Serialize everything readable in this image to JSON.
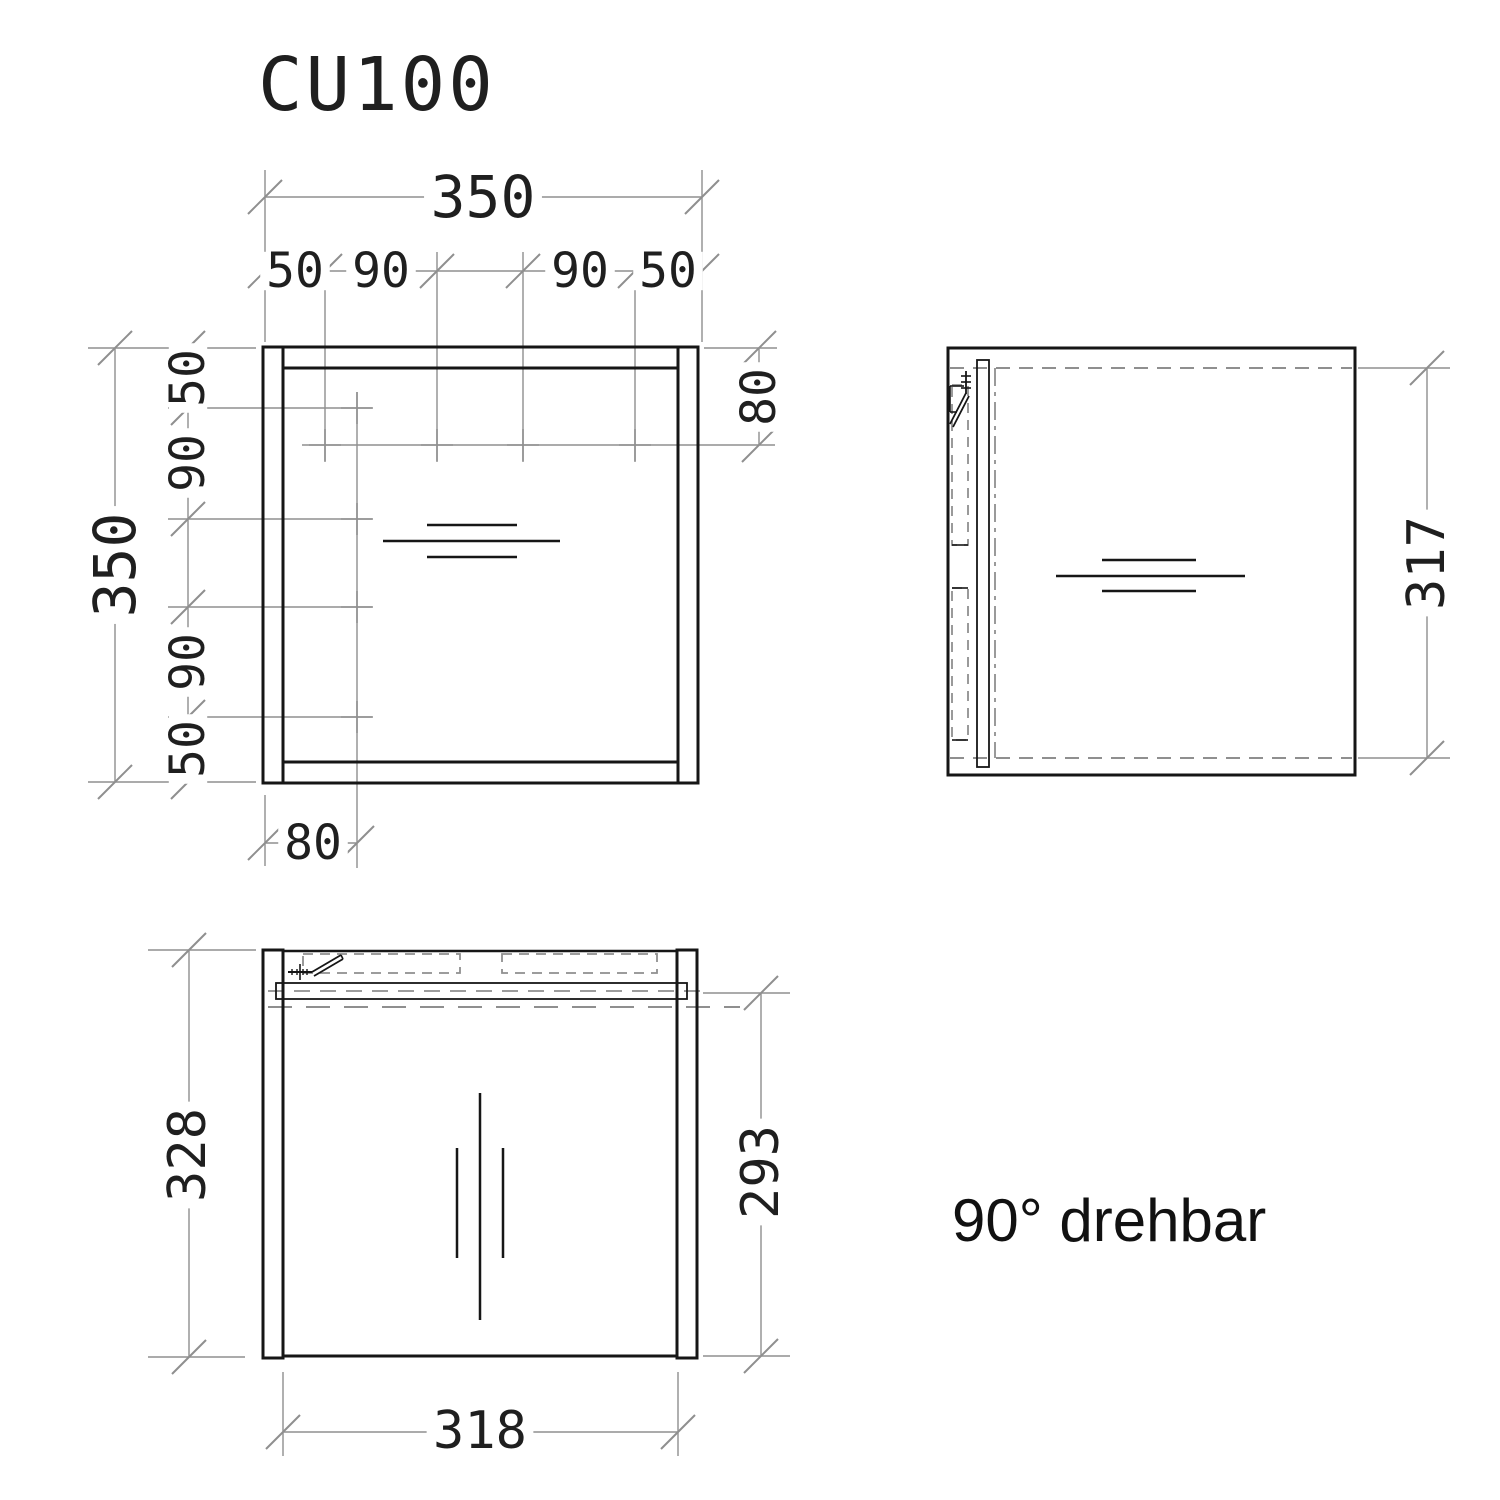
{
  "title": "CU100",
  "note": "90° drehbar",
  "colors": {
    "object": "#161616",
    "dim": "#8f8f8f",
    "text": "#1f1f1f",
    "bg": "#ffffff"
  },
  "views": {
    "front": {
      "name": "front-view",
      "overall_width": "350",
      "overall_height": "350",
      "hole_chain_horizontal": [
        "50",
        "90",
        "90",
        "50"
      ],
      "hole_chain_vertical": [
        "50",
        "90",
        "90",
        "50"
      ],
      "hole_line_offset_bottom": "80",
      "hole_row_offset_top": "80"
    },
    "side": {
      "name": "side-view",
      "door_height": "317"
    },
    "top": {
      "name": "top-view",
      "depth": "328",
      "inner_width": "318",
      "door_plane_depth": "293"
    }
  },
  "drawing": {
    "ext_lines": [
      [
        265,
        197,
        702,
        197
      ],
      [
        265,
        271,
        702,
        271
      ],
      [
        265,
        170,
        265,
        342
      ],
      [
        702,
        170,
        702,
        342
      ],
      [
        325,
        252,
        325,
        462
      ],
      [
        437,
        252,
        437,
        462
      ],
      [
        523,
        252,
        523,
        462
      ],
      [
        635,
        252,
        635,
        462
      ],
      [
        115,
        348,
        115,
        782
      ],
      [
        188,
        348,
        188,
        782
      ],
      [
        88,
        348,
        256,
        348
      ],
      [
        88,
        782,
        256,
        782
      ],
      [
        168,
        408,
        372,
        408
      ],
      [
        168,
        519,
        372,
        519
      ],
      [
        168,
        607,
        372,
        607
      ],
      [
        168,
        717,
        372,
        717
      ],
      [
        357,
        392,
        357,
        868
      ],
      [
        302,
        445,
        775,
        445
      ],
      [
        265,
        843,
        357,
        843
      ],
      [
        265,
        795,
        265,
        866
      ],
      [
        759,
        348,
        759,
        445
      ],
      [
        704,
        348,
        777,
        348
      ],
      [
        1427,
        368,
        1427,
        758
      ],
      [
        1358,
        368,
        1450,
        368
      ],
      [
        1358,
        758,
        1450,
        758
      ],
      [
        189,
        950,
        189,
        1357
      ],
      [
        148,
        950,
        256,
        950
      ],
      [
        148,
        1357,
        245,
        1357
      ],
      [
        761,
        993,
        761,
        1356
      ],
      [
        703,
        993,
        790,
        993
      ],
      [
        703,
        1356,
        790,
        1356
      ],
      [
        283,
        1432,
        678,
        1432
      ],
      [
        283,
        1372,
        283,
        1456
      ],
      [
        678,
        1372,
        678,
        1456
      ]
    ],
    "dashed_lines": [
      [
        950,
        368,
        1352,
        368,
        "14 9",
        2
      ],
      [
        950,
        758,
        1352,
        758,
        "14 9",
        2
      ],
      [
        995,
        368,
        995,
        758,
        "18 6 4 6",
        1.8
      ],
      [
        268,
        991,
        700,
        991,
        "16 10",
        1.8
      ],
      [
        268,
        1007,
        740,
        1007,
        "24 14",
        2
      ]
    ],
    "dashed_rects": [
      [
        952,
        385,
        16,
        160
      ],
      [
        952,
        588,
        16,
        152
      ],
      [
        303,
        954,
        157,
        19
      ],
      [
        502,
        954,
        155,
        19
      ]
    ],
    "crosses": [
      [
        357,
        408
      ],
      [
        357,
        519
      ],
      [
        357,
        607
      ],
      [
        357,
        717
      ],
      [
        325,
        445
      ],
      [
        437,
        445
      ],
      [
        523,
        445
      ],
      [
        635,
        445
      ]
    ],
    "ticks": [
      [
        265,
        197
      ],
      [
        702,
        197
      ],
      [
        265,
        271
      ],
      [
        325,
        271
      ],
      [
        437,
        271
      ],
      [
        523,
        271
      ],
      [
        635,
        271
      ],
      [
        702,
        271
      ],
      [
        115,
        348
      ],
      [
        115,
        782
      ],
      [
        188,
        348
      ],
      [
        188,
        408
      ],
      [
        188,
        519
      ],
      [
        188,
        607
      ],
      [
        188,
        717
      ],
      [
        188,
        782
      ],
      [
        265,
        843
      ],
      [
        357,
        843
      ],
      [
        759,
        348
      ],
      [
        759,
        445
      ],
      [
        1427,
        368
      ],
      [
        1427,
        758
      ],
      [
        189,
        950
      ],
      [
        189,
        1357
      ],
      [
        761,
        993
      ],
      [
        761,
        1356
      ],
      [
        283,
        1432
      ],
      [
        678,
        1432
      ]
    ],
    "rects": [
      [
        263,
        347,
        20,
        436,
        3
      ],
      [
        678,
        347,
        20,
        436,
        3
      ],
      [
        283,
        347,
        395,
        21,
        3
      ],
      [
        283,
        762,
        395,
        21,
        3
      ],
      [
        948,
        348,
        407,
        427,
        3
      ],
      [
        977,
        360,
        12,
        407,
        1.8
      ],
      [
        263,
        950,
        20,
        408,
        3
      ],
      [
        677,
        950,
        20,
        408,
        3
      ],
      [
        276,
        983,
        411,
        16,
        1.8
      ]
    ],
    "lines": [
      [
        283,
        951,
        677,
        951,
        2.5
      ],
      [
        283,
        1356,
        677,
        1356,
        3
      ],
      [
        427,
        525,
        517,
        525,
        2.5
      ],
      [
        383,
        541,
        560,
        541,
        2.5
      ],
      [
        427,
        557,
        517,
        557,
        2.5
      ],
      [
        1102,
        560,
        1196,
        560,
        2.5
      ],
      [
        1056,
        576,
        1245,
        576,
        2.5
      ],
      [
        1102,
        591,
        1196,
        591,
        2.5
      ],
      [
        480,
        1093,
        480,
        1320,
        2.5
      ],
      [
        457,
        1148,
        457,
        1258,
        2.5
      ],
      [
        503,
        1148,
        503,
        1258,
        2.5
      ],
      [
        966,
        371,
        966,
        394,
        1.8
      ],
      [
        961,
        376,
        971,
        376,
        1.6
      ],
      [
        961,
        382,
        971,
        382,
        1.6
      ],
      [
        961,
        388,
        971,
        388,
        1.6
      ],
      [
        966,
        393,
        950,
        424,
        1.8
      ],
      [
        969,
        396,
        953,
        427,
        1.8
      ],
      [
        950,
        386,
        964,
        386,
        1.6
      ],
      [
        950,
        386,
        950,
        412,
        1.6
      ],
      [
        950,
        412,
        957,
        412,
        1.6
      ],
      [
        952,
        545,
        968,
        545,
        1.6
      ],
      [
        952,
        588,
        968,
        588,
        1.6
      ],
      [
        952,
        740,
        968,
        740,
        1.6
      ],
      [
        288,
        972,
        312,
        972,
        2
      ],
      [
        300,
        964,
        300,
        980,
        1.6
      ],
      [
        292,
        969,
        292,
        975,
        1.4
      ],
      [
        297,
        969,
        297,
        975,
        1.4
      ],
      [
        303,
        969,
        303,
        975,
        1.4
      ],
      [
        307,
        969,
        307,
        975,
        1.4
      ],
      [
        312,
        972,
        341,
        955,
        1.8
      ],
      [
        314,
        976,
        343,
        959,
        1.8
      ],
      [
        341,
        955,
        343,
        959,
        1.6
      ]
    ],
    "dim_texts": [
      {
        "t": "350",
        "x": 483,
        "y": 197,
        "rot": 0,
        "fs": 58
      },
      {
        "t": "50",
        "x": 295,
        "y": 271,
        "rot": 0,
        "fs": 48
      },
      {
        "t": "90",
        "x": 381,
        "y": 271,
        "rot": 0,
        "fs": 48
      },
      {
        "t": "90",
        "x": 580,
        "y": 271,
        "rot": 0,
        "fs": 48
      },
      {
        "t": "50",
        "x": 668,
        "y": 271,
        "rot": 0,
        "fs": 48
      },
      {
        "t": "350",
        "x": 115,
        "y": 565,
        "rot": -90,
        "fs": 58
      },
      {
        "t": "50",
        "x": 188,
        "y": 378,
        "rot": -90,
        "fs": 48
      },
      {
        "t": "90",
        "x": 188,
        "y": 463,
        "rot": -90,
        "fs": 48
      },
      {
        "t": "90",
        "x": 188,
        "y": 662,
        "rot": -90,
        "fs": 48
      },
      {
        "t": "50",
        "x": 188,
        "y": 749,
        "rot": -90,
        "fs": 48
      },
      {
        "t": "80",
        "x": 313,
        "y": 843,
        "rot": 0,
        "fs": 48
      },
      {
        "t": "80",
        "x": 759,
        "y": 397,
        "rot": -90,
        "fs": 48
      },
      {
        "t": "317",
        "x": 1427,
        "y": 563,
        "rot": -90,
        "fs": 52
      },
      {
        "t": "328",
        "x": 188,
        "y": 1155,
        "rot": -90,
        "fs": 52
      },
      {
        "t": "293",
        "x": 761,
        "y": 1172,
        "rot": -90,
        "fs": 52
      },
      {
        "t": "318",
        "x": 480,
        "y": 1431,
        "rot": 0,
        "fs": 52
      }
    ]
  }
}
